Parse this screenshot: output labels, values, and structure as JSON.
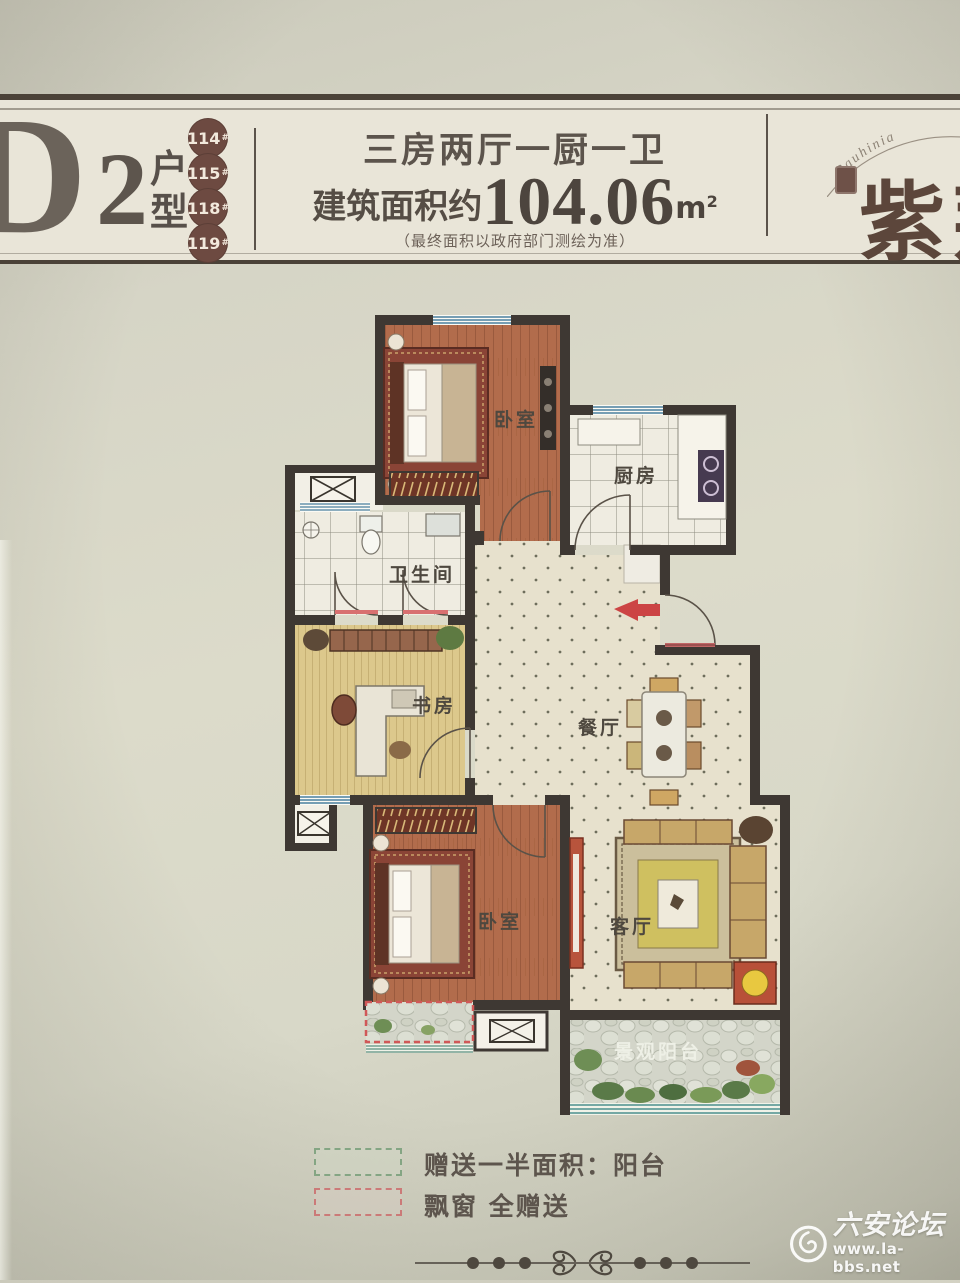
{
  "header": {
    "unit_letter": "D",
    "unit_number": "2",
    "unit_type_label": "户型",
    "building_badges": [
      "114",
      "115",
      "118",
      "119"
    ],
    "badge_suffix": "#",
    "layout_title": "三房两厅一厨一卫",
    "area_prefix": "建筑面积约",
    "area_value": "104.06",
    "area_unit": "m",
    "area_unit_sup": "2",
    "disclaimer": "（最终面积以政府部门测绘为准）",
    "brand_name": "紫荆",
    "brand_arc_text": "Bauhinia"
  },
  "floorplan": {
    "rooms": {
      "bedroom_top": "卧室",
      "kitchen": "厨房",
      "bathroom": "卫生间",
      "study": "书房",
      "dining": "餐厅",
      "bedroom_bottom": "卧室",
      "living": "客厅",
      "balcony": "景观阳台"
    }
  },
  "legend": {
    "items": [
      {
        "label": "赠送一半面积：阳台",
        "swatch_color": "#84a583"
      },
      {
        "label": "飘窗 全赠送",
        "swatch_color": "#cb7a78"
      }
    ]
  },
  "watermark": {
    "site_name": "六安论坛",
    "site_url": "www.la-bbs.net"
  },
  "colors": {
    "wall": "#3e3833",
    "wood_floor": "#b26c4c",
    "study_floor": "#dcc88c",
    "tile_floor": "#efece1",
    "hall_floor": "#e7e1cd",
    "window_blue": "#4a7f9e",
    "bay_window_red": "#d05858",
    "accent_red_arrow": "#cc4444"
  }
}
